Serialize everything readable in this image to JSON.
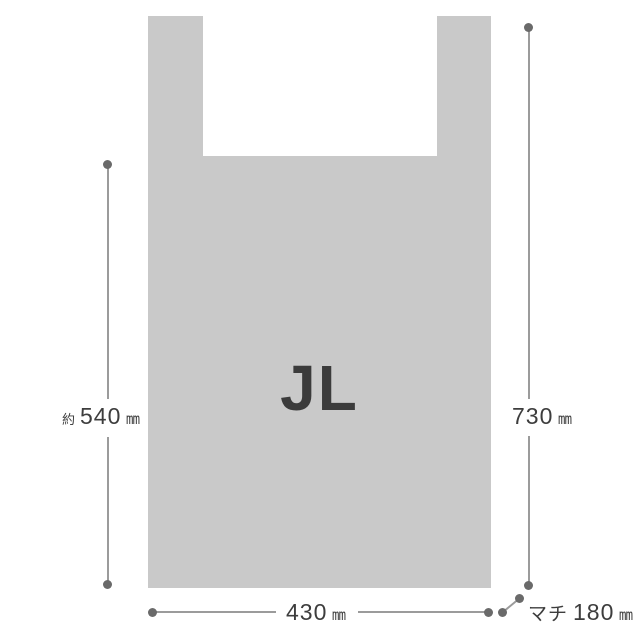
{
  "figure": {
    "bag_label": "JL",
    "colors": {
      "bag": "#c9c9c9",
      "line": "#9b9b9b",
      "dot": "#6a6a6a",
      "text": "#3d3d3d",
      "bg": "#ffffff"
    },
    "dimensions": {
      "height_partial": {
        "prefix": "約",
        "value": "540",
        "unit": "mm"
      },
      "height_total": {
        "value": "730",
        "unit": "mm"
      },
      "width": {
        "value": "430",
        "unit": "mm"
      },
      "gusset": {
        "prefix": "マチ",
        "value": "180",
        "unit": "mm"
      }
    }
  }
}
